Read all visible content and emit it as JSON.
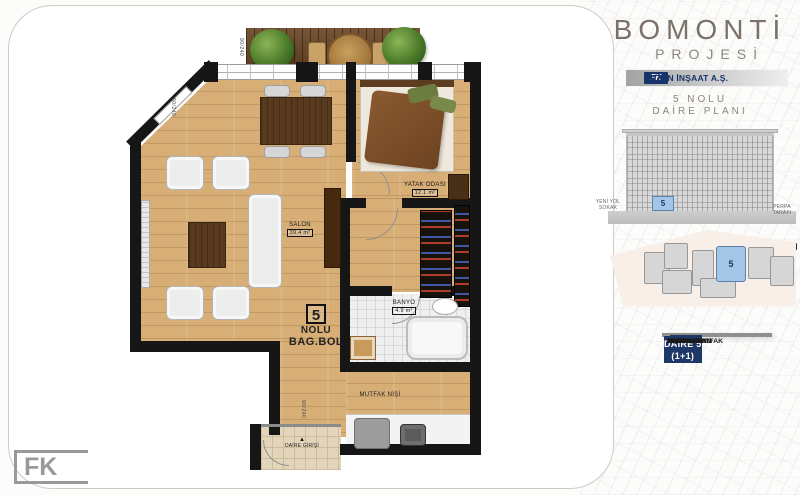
{
  "sidebar": {
    "title": "BOMONTİ",
    "subtitle": "PROJESİ",
    "brand": {
      "initials": "FK",
      "company": "KETEN İNŞAAT A.Ş."
    },
    "plan_title": {
      "line1": "5 NOLU",
      "line2": "DAİRE PLANI"
    },
    "facade": {
      "street_left_line1": "YENİ YOL",
      "street_left_line2": "SOKAK",
      "street_right": "PERPA TARAFI",
      "unit": "5"
    },
    "siteplan": {
      "unit": "5"
    },
    "table": {
      "title": "DAİRE 5",
      "type": "(1+1)",
      "rows": [
        {
          "label": "SALON+MUTFAK",
          "value": "39,4 m2"
        },
        {
          "label": "YATAK ODASI",
          "value": "12,1 m2"
        },
        {
          "label": "BANYO",
          "value": "4,9 m2"
        },
        {
          "label": "TERAS",
          "value": "3,0 m2"
        },
        {
          "label": "",
          "value": ""
        },
        {
          "label": "",
          "value": ""
        },
        {
          "label": "",
          "value": ""
        },
        {
          "label": "NET ALAN",
          "value": "59,4 m2"
        },
        {
          "label": "ORTAK ALAN",
          "value": "21,6 m2"
        },
        {
          "label": "BRÜT ALAN",
          "value": "81,0 m2"
        }
      ]
    }
  },
  "plan": {
    "badge": {
      "number": "5",
      "word1": "NOLU",
      "word2": "BAG.BOL"
    },
    "salon": {
      "name": "SALON",
      "area": "39.4 m²"
    },
    "bedroom": {
      "name": "YATAK ODASI",
      "area": "12.1 m²"
    },
    "bath": {
      "name": "BANYO",
      "area": "4.9 m²"
    },
    "kitchen": {
      "name": "MUTFAK NİŞİ"
    },
    "entrance": {
      "label": "DAİRE GİRİŞİ"
    },
    "dims": {
      "d1": "90/240",
      "d2": "90/240",
      "d3": "90/240"
    }
  },
  "icons": {
    "entrance_arrow": "▲",
    "nav_arrow": "◀"
  },
  "footer": {
    "logo": "FK"
  },
  "colors": {
    "navy": "#1d3767",
    "unit_blue": "#a3c6e6",
    "wood": "#d7ae76",
    "title_gray": "#7b7169"
  }
}
